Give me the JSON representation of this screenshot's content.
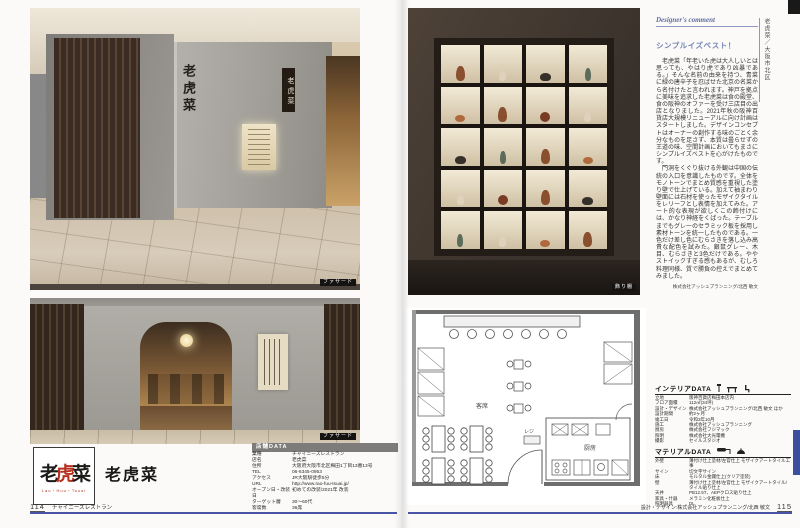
{
  "photos": {
    "sign_text": "老虎菜",
    "photo1_caption": "ファサード",
    "photo2_caption": "ファサード",
    "photo3_caption": "飾り棚"
  },
  "logo": {
    "chars": [
      "老",
      "虎",
      "菜"
    ],
    "romaji": "Lao・Huu・Tsuai",
    "shop_name": "老虎菜"
  },
  "side_tab": "老虎菜／大阪市北区",
  "designer_comment": {
    "header": "Designer's comment",
    "title": "シンプルイズベスト！",
    "para1": "老虎菜「年老いた虎は大人しいとは思っても、やはり虎であり凶暴である。」そんな名前の由来を持つ、青菜に緑の唐辛子を忍ばせた北京の名菜から名付けたと言われます。神戸を拠点に美味を追求した老虎菜は食の殿堂、食の阪神のオファーを受け三店目の出店となりました。2021年秋の阪神百貨店大規模リニューアルに向け計画はスタートしました。デザインコンセプトはオーナーの創作する味のごとく余分なものを足さず、本質は曇らせずの王道の味、空間計画においてもまさにシンプルイズベストを心がけたものです。",
    "para2": "門洞をくぐり抜ける外観は中国の伝統の入口を意識したものです。全体をモノトーンでまとめ質感を重視した塗り壁で仕上げている。加えて袖まわり壁面には石材を使ったモザイクタイルをレリーフとし表情を加えてみた。アート的な表現が欲しくこの飾付けには、かなり神経をくばった。テーブルまでもグレーのセラミック板を採用し素材トーンを統一したものである。一色だけ差し色にむらさきを落し込み高貴な配色を試みた。銀鼠グレー、木目、むらさきと3色だけである。ややストイックすぎる感もあるが、むしろ料理同様、質で勝負の控えでまとめてみました。",
    "credit": "株式会社アッシュプランニング/北西 敏文"
  },
  "shop_data": {
    "header": "店舗DATA",
    "rows": [
      [
        "業種",
        "チャイニーズレストラン"
      ],
      [
        "店名",
        "老虎菜"
      ],
      [
        "住所",
        "大阪府大阪市北区梅田1丁目13番13号"
      ],
      [
        "TEL",
        "06-6345-0953"
      ],
      [
        "アクセス",
        "JR大阪駅徒歩5分"
      ],
      [
        "URL",
        "http://www.rao-fuu-tsuai.jp/"
      ],
      [
        "オープン日・改装日",
        "初めての改装/2021年 改装"
      ],
      [
        "ターゲット層",
        "30〜60代"
      ],
      [
        "客席数",
        "36席"
      ]
    ]
  },
  "interior_data": {
    "header": "インテリアDATA",
    "rows": [
      [
        "立地",
        "阪神百貨店梅田本店内"
      ],
      [
        "フロア面積",
        "112㎡(34坪)"
      ],
      [
        "設計・デザイン",
        "株式会社アッシュプランニング/北西 敏文 ほか"
      ],
      [
        "設計期間",
        "約2ヶ月"
      ],
      [
        "竣工日",
        "令和3年10月"
      ],
      [
        "施工",
        "株式会社アッシュプランニング"
      ],
      [
        "厨房",
        "株式会社フジマック"
      ],
      [
        "照明",
        "株式会社大光電機"
      ],
      [
        "撮影",
        "セイルスタジオ"
      ]
    ]
  },
  "material_data": {
    "header": "マテリアルDATA",
    "rows": [
      [
        "外壁",
        "薄付け仕上塗材/左官仕上 モザイクアートタイル工事"
      ],
      [
        "サイン",
        "切文字サイン"
      ],
      [
        "床",
        "モルタル金鏝仕上(クリア塗装)"
      ],
      [
        "壁",
        "薄付け仕上塗材/左官仕上 モザイクアートタイル/タイル貼り仕上"
      ],
      [
        "天井",
        "PB12.5T、AEPクロス貼り仕上"
      ],
      [
        "家具・什器",
        "メラミン化粧板仕上"
      ],
      [
        "照明器具",
        "DL"
      ]
    ]
  },
  "floor_plan": {
    "labels": [
      "客席",
      "厨房",
      "レジ"
    ]
  },
  "footer": {
    "left_page": "114",
    "left_label": "チャイニーズレストラン",
    "right_credit": "設計・デザイン:株式会社アッシュプランニング/北西 敏文",
    "right_page": "115"
  }
}
